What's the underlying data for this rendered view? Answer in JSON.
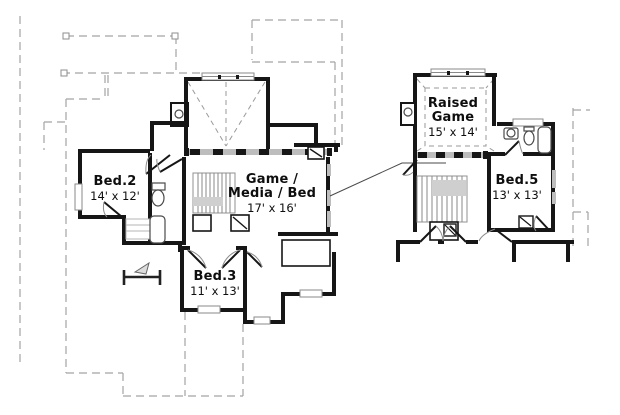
{
  "canvas": {
    "width": 620,
    "height": 415,
    "background": "#ffffff"
  },
  "colors": {
    "wall": "#161616",
    "roof_dash": "#a3a3a3",
    "railing_gray": "#bdbdbd",
    "stair_gray": "#8f8f8f",
    "text": "#0e0e0e"
  },
  "left_plan": {
    "rooms": [
      {
        "id": "bed2",
        "name": "Bed.2",
        "dims": "14' x 12'"
      },
      {
        "id": "game-media-bed",
        "name_line1": "Game /",
        "name_line2": "Media / Bed",
        "dims": "17' x 16'"
      },
      {
        "id": "bed3",
        "name": "Bed.3",
        "dims": "11' x 13'"
      }
    ]
  },
  "right_plan": {
    "rooms": [
      {
        "id": "raised-game",
        "name_line1": "Raised",
        "name_line2": "Game",
        "dims": "15' x 14'"
      },
      {
        "id": "bed5",
        "name": "Bed.5",
        "dims": "13' x 13'"
      }
    ]
  }
}
